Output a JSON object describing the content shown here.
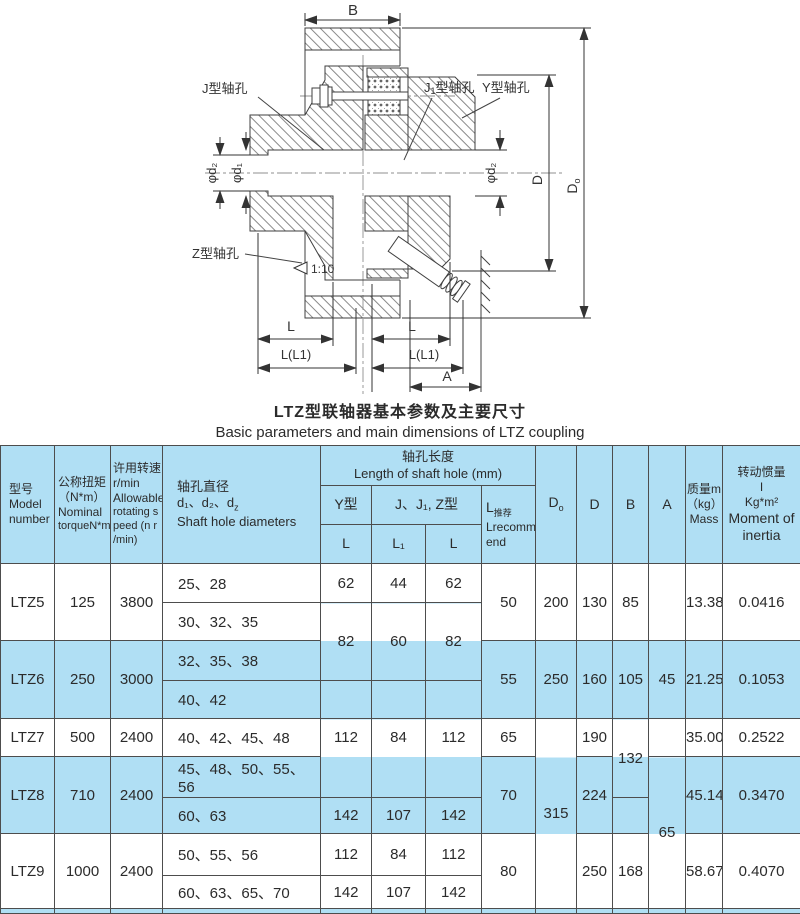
{
  "drawing": {
    "dims": {
      "b": "B",
      "d": "D",
      "d0_main": "D",
      "d0_sub": "o",
      "phi_d2_left": "φd₂",
      "phi_d1": "φd₁",
      "phi_d2_right": "φd₂",
      "l_left": "L",
      "l_right": "L",
      "ll1_left": "L(L1)",
      "ll1_right": "L(L1)",
      "a": "A",
      "taper": "1:10"
    },
    "labels": {
      "j_hole": "J型轴孔",
      "j1_main": "J",
      "j1_sub": "1",
      "j1_rest": "型轴孔",
      "y_hole": "Y型轴孔",
      "z_hole": "Z型轴孔"
    }
  },
  "title": {
    "zh": "LTZ型联轴器基本参数及主要尺寸",
    "en": "Basic parameters and main dimensions of LTZ coupling"
  },
  "table": {
    "header": {
      "model_zh": "型号",
      "model_en1": "Model",
      "model_en2": "number",
      "torque_l1": "公称扭矩",
      "torque_l2": "（N*m）",
      "torque_l3": "Nominal",
      "torque_l4": "torqueN*m",
      "speed_l1": "许用转速",
      "speed_l2": "r/min",
      "speed_l3": "Allowable",
      "speed_l4": "rotating s",
      "speed_l5": "peed (n  r",
      "speed_l6": "/min)",
      "bore_l1": "轴孔直径",
      "bore_l2a": "d₁、d₂、d",
      "bore_l2b": "z",
      "bore_l3": "Shaft hole diameters",
      "len_zh": "轴孔长度",
      "len_en": "Length of shaft hole (mm)",
      "y_type": "Y型",
      "jjz": "J、J₁, Z型",
      "L": "L",
      "L1": "L₁",
      "L2": "L",
      "lrec_main": "L",
      "lrec_sub": "推荐",
      "lrec_en1": "Lrecomm",
      "lrec_en2": "end",
      "d0_main": "D",
      "d0_sub": "o",
      "d": "D",
      "b": "B",
      "a": "A",
      "mass_l1": "质量m",
      "mass_l2": "（kg）",
      "mass_l3": "Mass",
      "moi_l1": "转动惯量",
      "moi_l2": "I",
      "moi_l3": "Kg*m²",
      "moi_l4": "Moment of",
      "moi_l5": "inertia"
    },
    "rows": {
      "ltz5": {
        "model": "LTZ5",
        "torque": "125",
        "speed": "3800",
        "bores_a": "25、28",
        "bores_b": "30、32、35",
        "l": "62",
        "l1": "44",
        "lz": "62",
        "lrec": "50",
        "d0": "200",
        "d": "130",
        "b": "85",
        "mass": "13.38",
        "moi": "0.0416"
      },
      "shared56": {
        "l": "82",
        "l1": "60",
        "lz": "82"
      },
      "ltz6": {
        "model": "LTZ6",
        "torque": "250",
        "speed": "3000",
        "bores_a": "32、35、38",
        "bores_b": "40、42",
        "lrec": "55",
        "d0": "250",
        "d": "160",
        "b": "105",
        "a": "45",
        "mass": "21.25",
        "moi": "0.1053"
      },
      "ltz7": {
        "model": "LTZ7",
        "torque": "500",
        "speed": "2400",
        "bores_a": "40、42、45、48",
        "l": "112",
        "l1": "84",
        "lz": "112",
        "lrec": "65",
        "d": "190",
        "mass": "35.00",
        "moi": "0.2522"
      },
      "shared789": {
        "d0": "315"
      },
      "shared78": {
        "b": "132"
      },
      "shared89": {
        "a": "65"
      },
      "ltz8": {
        "model": "LTZ8",
        "torque": "710",
        "speed": "2400",
        "bores_a": "45、48、50、55、56",
        "bores_b": "60、63",
        "l": "142",
        "l1": "107",
        "lz": "142",
        "lrec": "70",
        "d": "224",
        "mass": "45.14",
        "moi": "0.3470"
      },
      "ltz9": {
        "model": "LTZ9",
        "torque": "1000",
        "speed": "2400",
        "bores_a": "50、55、56",
        "bores_b": "60、63、65、70",
        "l_a": "112",
        "l1_a": "84",
        "lz_a": "112",
        "l_b": "142",
        "l1_b": "107",
        "lz_b": "142",
        "lrec": "80",
        "d": "250",
        "b": "168",
        "mass": "58.67",
        "moi": "0.4070"
      }
    }
  },
  "colors": {
    "highlight": "#b0dff4",
    "line": "#444444",
    "border": "#4d4d4d"
  }
}
